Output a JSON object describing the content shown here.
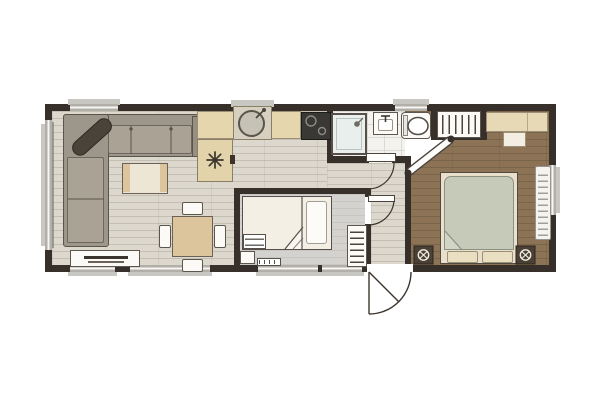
{
  "plan": {
    "type": "floorplan",
    "description": "Top-down 2D floor plan of a two-bedroom holiday home / static caravan",
    "rooms": [
      {
        "name": "living-room",
        "furniture": [
          "corner-sofa",
          "bolster-cushion",
          "coffee-table",
          "dining-table",
          "chair",
          "chair",
          "chair",
          "chair",
          "tv-unit"
        ]
      },
      {
        "name": "kitchen",
        "furniture": [
          "worktop",
          "round-sink",
          "tap",
          "hob",
          "appliance-with-vent"
        ]
      },
      {
        "name": "bathroom",
        "furniture": [
          "shower-enclosure",
          "washbasin",
          "toilet"
        ]
      },
      {
        "name": "twin-bedroom",
        "furniture": [
          "bed",
          "pillow",
          "steps-shelf",
          "bedside-unit",
          "heater",
          "wardrobe-rail"
        ]
      },
      {
        "name": "hallway",
        "furniture": []
      },
      {
        "name": "master-bedroom",
        "furniture": [
          "double-bed",
          "pillow",
          "pillow",
          "bedside-table",
          "bedside-table",
          "wardrobe-rail",
          "dressing-table",
          "stool",
          "radiator"
        ]
      }
    ],
    "doors": [
      {
        "name": "entrance-door",
        "style": "quarter-swing",
        "location": "bottom-wall"
      },
      {
        "name": "bathroom-door",
        "style": "quarter-swing",
        "location": "corridor"
      },
      {
        "name": "twin-bedroom-door",
        "style": "quarter-swing",
        "location": "hallway"
      },
      {
        "name": "master-bedroom-door",
        "style": "diagonal-corner",
        "location": "hallway"
      }
    ],
    "windows": {
      "top": 2,
      "bottom": 4,
      "left": 1,
      "right": 1,
      "kitchen_bay": 1
    }
  },
  "colors": {
    "background": "#ffffff",
    "wall": "#37302a",
    "wood_floor": "#dcd8cd",
    "tile_floor": "#f3f2ee",
    "gray_floor": "#d3d2cf",
    "brown_floor": "#8c7356",
    "counter": "#e6d6ad",
    "sofa": "#9d968a",
    "accent_cream": "#efe8d7",
    "accent_tan": "#dcc49d",
    "duvet_green": "#c6cab9",
    "window_glass": "#b2afa9"
  }
}
